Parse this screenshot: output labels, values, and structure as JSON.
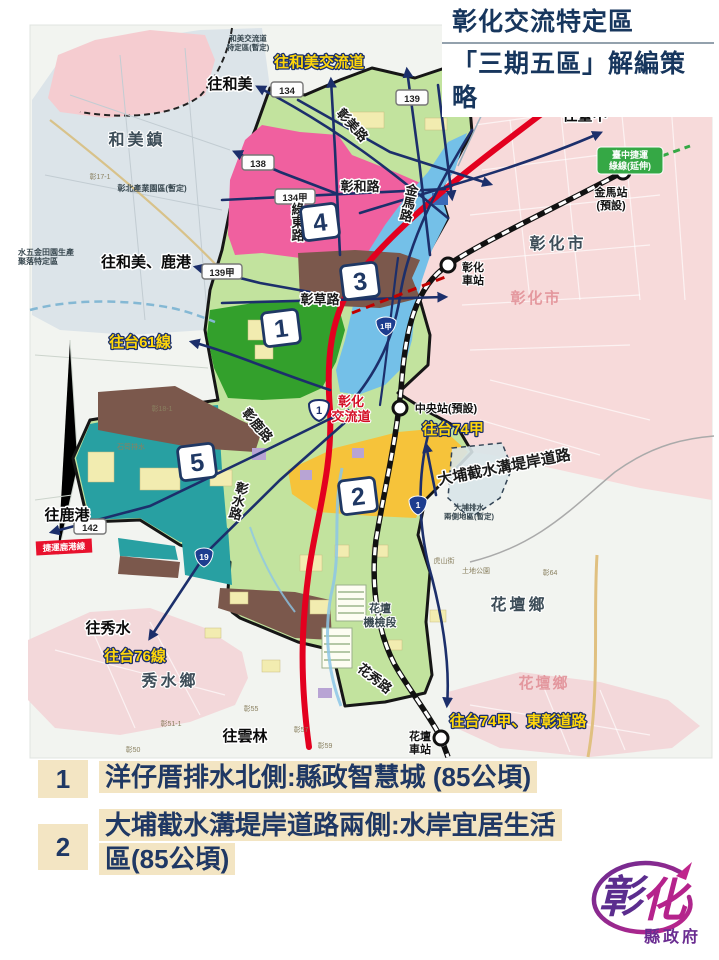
{
  "title": {
    "line1": "彰化交流特定區",
    "line2": "「三期五區」解編策略"
  },
  "legend": [
    {
      "num": "1",
      "text": "洋仔厝排水北側:縣政智慧城 (85公頃)"
    },
    {
      "num": "2",
      "text": "大埔截水溝堤岸道路兩側:水岸宜居生活區(85公頃)"
    }
  ],
  "logo": {
    "char1": "彰",
    "char2": "化",
    "sub": "縣政府"
  },
  "colors": {
    "zone1": "#33a02c",
    "zone2": "#f6c33a",
    "zone3": "#74c0e8",
    "zone4": "#f0609f",
    "zone5": "#28a0a2",
    "highway": "#e3001f",
    "road": "#1c2f6b",
    "title_text": "#17365d",
    "legend_highlight": "#f3e5c3"
  },
  "map": {
    "zones": [
      "1",
      "2",
      "3",
      "4",
      "5"
    ],
    "towns": [
      "和美鎮",
      "彰化市",
      "秀水鄉",
      "花壇鄉"
    ],
    "faded_towns": [
      "彰化市",
      "花壇鄉"
    ],
    "roads": {
      "changmei": "彰美路",
      "changhe": "彰和路",
      "lvdong": "綠東路",
      "changcao": "彰草路",
      "jinma": "金馬路",
      "changlu": "彰鹿路",
      "changshui": "彰水路",
      "huaxiu": "花秀路",
      "dapu": "大埔截水溝堤岸道路"
    },
    "directions_black": [
      "往和美",
      "往和美、鹿港",
      "往臺中",
      "往鹿港",
      "往秀水",
      "往雲林"
    ],
    "directions_yellow": [
      "往和美交流道",
      "往台61線",
      "往台76線",
      "往台74甲",
      "往台74甲、東彰道路"
    ],
    "interchanges": [
      {
        "l1": "彰化系統",
        "l2": "交流道"
      },
      {
        "l1": "彰化",
        "l2": "交流道"
      }
    ],
    "stations": [
      {
        "l1": "金馬站",
        "l2": "(預設)"
      },
      {
        "l1": "彰化",
        "l2": "車站"
      },
      {
        "l1": "中央站(預設)",
        "l2": ""
      },
      {
        "l1": "花壇",
        "l2": "車站"
      }
    ],
    "districts": [
      {
        "l1": "和美交流道",
        "l2": "特定區(暫定)"
      },
      {
        "l1": "彰北產業園區(暫定)",
        "l2": ""
      },
      {
        "l1": "水五金田園生產",
        "l2": "聚落特定區"
      },
      {
        "l1": "花壇",
        "l2": "機檢段"
      },
      {
        "l1": "大埔排水",
        "l2": "兩側地區(暫定)"
      }
    ],
    "route_badges": [
      "134",
      "138",
      "139",
      "134甲",
      "139甲",
      "142"
    ],
    "shield_badges": [
      "19",
      "1甲",
      "1"
    ],
    "interchange_shield": "1",
    "metro_badge": {
      "l1": "臺中捷運",
      "l2": "綠線(延伸)"
    },
    "lukang_badge": "捷運鹿港線",
    "micro_labels": [
      "彰17-1",
      "彰18-1",
      "石笱排水",
      "彰51-1",
      "彰50",
      "彰55",
      "彰57",
      "彰59",
      "彰64",
      "土地公園",
      "虎山街"
    ]
  }
}
